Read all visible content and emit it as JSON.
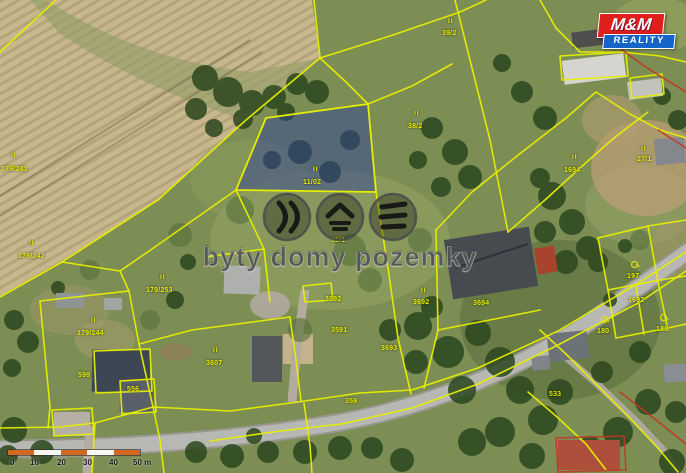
{
  "branding": {
    "logo_line1": "M&M",
    "logo_line2": "REALITY",
    "logo_colors": {
      "top_bg": "#e01f1d",
      "bottom_bg": "#1565c8",
      "text": "#ffffff"
    }
  },
  "watermark": {
    "text": "byty domy pozemky",
    "icons": [
      "waves-chevron-icon",
      "roof-icon",
      "terrain-layers-icon"
    ]
  },
  "map": {
    "type": "cadastral-aerial",
    "highlighted_parcel": {
      "label": "11/02",
      "fill": "#2e3f9b"
    },
    "colors": {
      "parcel_line": "#e6ee00",
      "secondary_line": "#c23726",
      "field": "#c8b78c",
      "grass": "#7c8e53",
      "road": "#b7b7b3"
    },
    "labels": [
      {
        "text": "II",
        "x": 11,
        "y": 152,
        "kind": "symbol"
      },
      {
        "text": "179/241",
        "x": 1,
        "y": 166,
        "kind": "number"
      },
      {
        "text": "II",
        "x": 29,
        "y": 240,
        "kind": "symbol"
      },
      {
        "text": "179/242",
        "x": 18,
        "y": 253,
        "kind": "number"
      },
      {
        "text": "II",
        "x": 448,
        "y": 18,
        "kind": "symbol"
      },
      {
        "text": "39/2",
        "x": 442,
        "y": 30,
        "kind": "number"
      },
      {
        "text": "II",
        "x": 414,
        "y": 110,
        "kind": "symbol"
      },
      {
        "text": "38/2",
        "x": 408,
        "y": 123,
        "kind": "number"
      },
      {
        "text": "II",
        "x": 313,
        "y": 166,
        "kind": "symbol"
      },
      {
        "text": "11/02",
        "x": 303,
        "y": 179,
        "kind": "number"
      },
      {
        "text": "II",
        "x": 336,
        "y": 226,
        "kind": "symbol"
      },
      {
        "text": "35/1",
        "x": 331,
        "y": 237,
        "kind": "number"
      },
      {
        "text": "II",
        "x": 160,
        "y": 274,
        "kind": "symbol"
      },
      {
        "text": "179/253",
        "x": 146,
        "y": 287,
        "kind": "number"
      },
      {
        "text": "II",
        "x": 91,
        "y": 317,
        "kind": "symbol"
      },
      {
        "text": "179/244",
        "x": 77,
        "y": 330,
        "kind": "number"
      },
      {
        "text": "II",
        "x": 213,
        "y": 347,
        "kind": "symbol"
      },
      {
        "text": "3607",
        "x": 206,
        "y": 360,
        "kind": "number"
      },
      {
        "text": "3592",
        "x": 325,
        "y": 296,
        "kind": "number"
      },
      {
        "text": "3591",
        "x": 331,
        "y": 327,
        "kind": "number"
      },
      {
        "text": "II",
        "x": 421,
        "y": 287,
        "kind": "symbol"
      },
      {
        "text": "3692",
        "x": 413,
        "y": 299,
        "kind": "number"
      },
      {
        "text": "3694",
        "x": 473,
        "y": 300,
        "kind": "number"
      },
      {
        "text": "3693",
        "x": 381,
        "y": 345,
        "kind": "number"
      },
      {
        "text": "II",
        "x": 572,
        "y": 154,
        "kind": "symbol"
      },
      {
        "text": "1694",
        "x": 564,
        "y": 167,
        "kind": "number"
      },
      {
        "text": "II",
        "x": 641,
        "y": 146,
        "kind": "symbol"
      },
      {
        "text": "27/1",
        "x": 637,
        "y": 156,
        "kind": "number"
      },
      {
        "text": "197",
        "x": 627,
        "y": 273,
        "kind": "number"
      },
      {
        "text": "1692",
        "x": 628,
        "y": 297,
        "kind": "number"
      },
      {
        "text": "180",
        "x": 597,
        "y": 328,
        "kind": "number"
      },
      {
        "text": "188",
        "x": 656,
        "y": 326,
        "kind": "number"
      },
      {
        "text": "533",
        "x": 549,
        "y": 391,
        "kind": "number"
      },
      {
        "text": "359",
        "x": 345,
        "y": 398,
        "kind": "number"
      },
      {
        "text": "599",
        "x": 78,
        "y": 372,
        "kind": "number"
      },
      {
        "text": "556",
        "x": 127,
        "y": 386,
        "kind": "number"
      },
      {
        "text": "",
        "x": 631,
        "y": 261,
        "kind": "garden"
      },
      {
        "text": "",
        "x": 601,
        "y": 316,
        "kind": "garden"
      },
      {
        "text": "",
        "x": 660,
        "y": 314,
        "kind": "garden"
      }
    ]
  },
  "scalebar": {
    "ticks": [
      {
        "label": "0",
        "x": 4
      },
      {
        "label": "10",
        "x": 24
      },
      {
        "label": "20",
        "x": 51
      },
      {
        "label": "30",
        "x": 77
      },
      {
        "label": "40",
        "x": 103
      },
      {
        "label": "50 m",
        "x": 127
      }
    ],
    "segments": [
      "#d2691e",
      "#f7f5f0",
      "#d2691e",
      "#f7f5f0",
      "#d2691e"
    ]
  }
}
